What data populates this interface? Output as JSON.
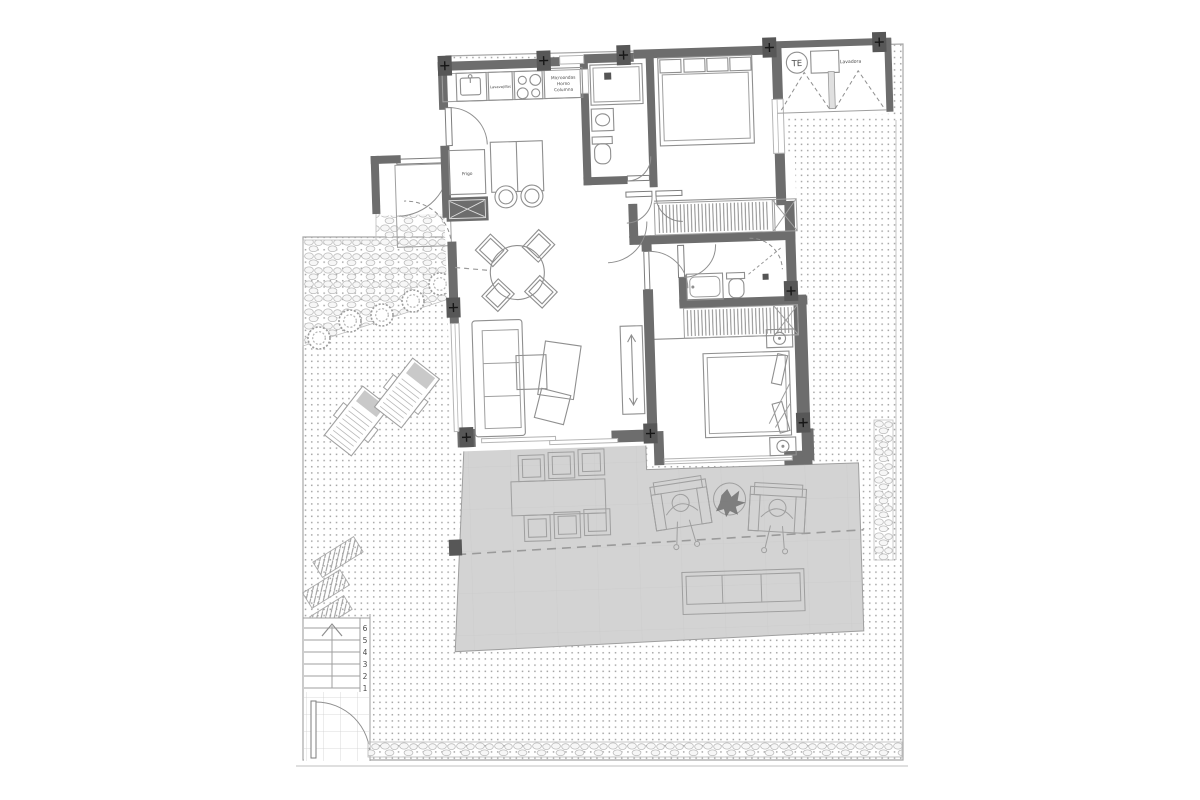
{
  "plan": {
    "labels": {
      "dishwasher": "Lavavajillas",
      "tall_unit_lines": [
        "Microondas",
        "Horno",
        "Columna"
      ],
      "fridge": "Frigo",
      "water_heater": "TE",
      "washer": "Lavadora"
    },
    "stairs": {
      "step_numbers": [
        "6",
        "5",
        "4",
        "3",
        "2",
        "1"
      ]
    },
    "colors": {
      "wall": "#6d6d6d",
      "terrace_floor": "#d3d3d3",
      "line": "#8f8f8f",
      "text": "#4a4a4a",
      "lounger_cushion": "#c9c9c9",
      "background": "#ffffff"
    }
  }
}
